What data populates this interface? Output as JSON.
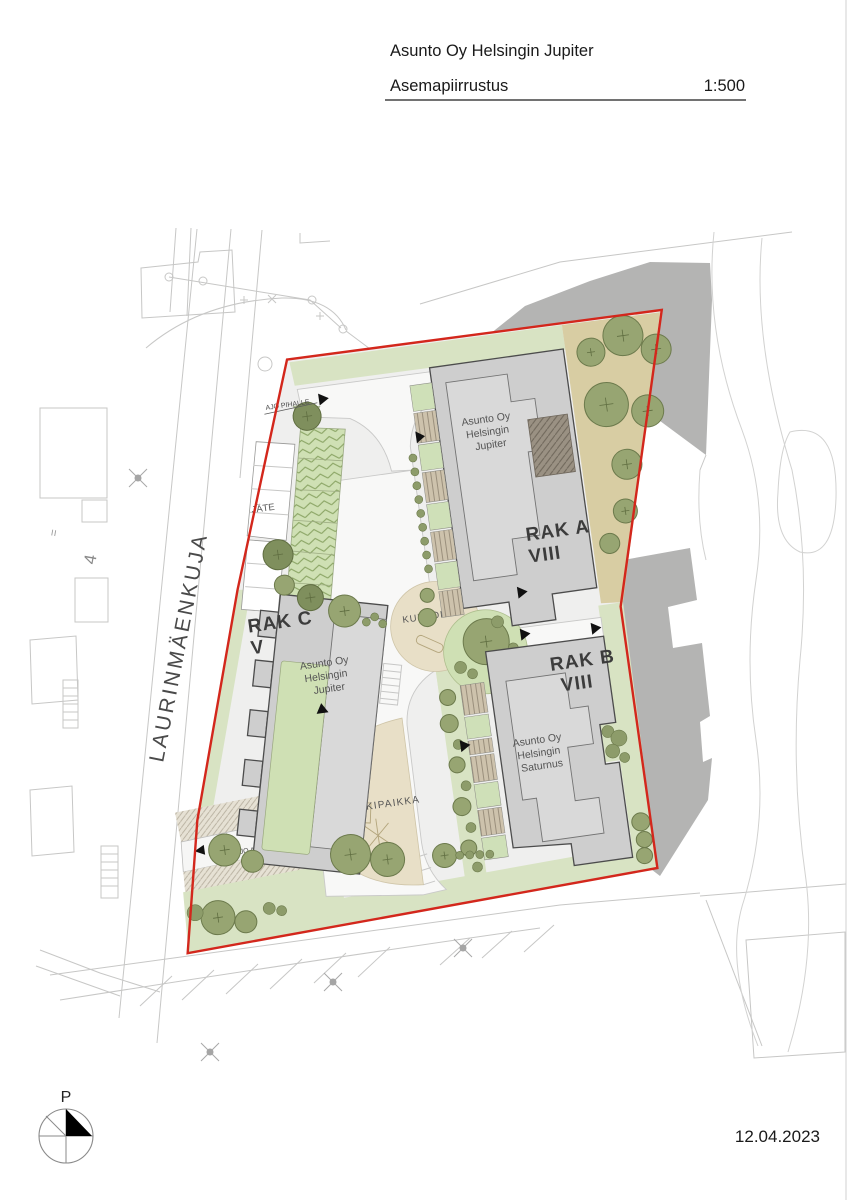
{
  "title_block": {
    "project_name": "Asunto Oy Helsingin Jupiter",
    "drawing_type": "Asemapiirrustus",
    "scale": "1:500"
  },
  "footer": {
    "date": "12.04.2023",
    "north_label": "P"
  },
  "context": {
    "street_name": "LAURINMÄENKUJA",
    "plot_number": "4",
    "level_mark": "="
  },
  "buildings": {
    "rak_a": {
      "code": "RAK A",
      "floors": "VIII",
      "owner_line1": "Asunto Oy",
      "owner_line2": "Helsingin",
      "owner_line3": "Jupiter"
    },
    "rak_b": {
      "code": "RAK B",
      "floors": "VIII",
      "owner_line1": "Asunto Oy",
      "owner_line2": "Helsingin",
      "owner_line3": "Saturnus"
    },
    "rak_c": {
      "code": "RAK C",
      "floors": "V",
      "owner_line1": "Asunto Oy",
      "owner_line2": "Helsingin",
      "owner_line3": "Jupiter"
    }
  },
  "annotations": {
    "waste": "JÄTE",
    "fitness": "KUNTOILU",
    "playground": "LEIKKIPAIKKA",
    "drive_to_yard": "AJO PIHALLE",
    "drive_to_garage": "AJO AUTOHALLIIN"
  },
  "colors": {
    "site_boundary": "#d3271c",
    "building_fill": "#cecece",
    "building_outline": "#4c4c4c",
    "green_area": "#d8e3c3",
    "planting": "#cfe0b4",
    "tree": "#97a572",
    "sand": "#d8cda3",
    "play_area": "#e8dfc7",
    "neighbor_mass": "#b4b4b3",
    "paving": "#efefee"
  }
}
